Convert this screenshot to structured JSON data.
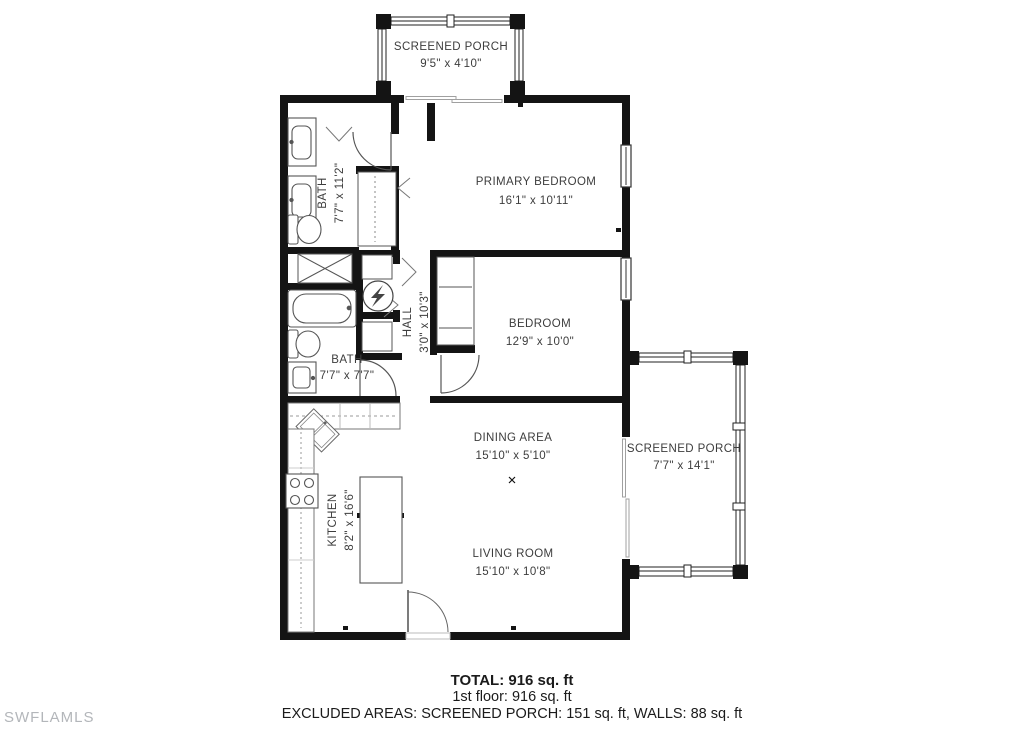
{
  "watermark": "SWFLAMLS",
  "rooms": {
    "screened_porch_top": {
      "name": "SCREENED PORCH",
      "dims": "9'5\" x 4'10\""
    },
    "primary_bedroom": {
      "name": "PRIMARY BEDROOM",
      "dims": "16'1\" x 10'11\""
    },
    "bath_upper": {
      "name": "BATH",
      "dims": "7'7\" x 11'2\""
    },
    "bedroom": {
      "name": "BEDROOM",
      "dims": "12'9\" x 10'0\""
    },
    "hall": {
      "name": "HALL",
      "dims": "3'0\" x 10'3\""
    },
    "bath_lower": {
      "name": "BATH",
      "dims": "7'7\" x 7'7\""
    },
    "kitchen": {
      "name": "KITCHEN",
      "dims": "8'2\" x 16'6\""
    },
    "dining_area": {
      "name": "DINING AREA",
      "dims": "15'10\" x 5'10\""
    },
    "living_room": {
      "name": "LIVING ROOM",
      "dims": "15'10\" x 10'8\""
    },
    "screened_porch_right": {
      "name": "SCREENED PORCH",
      "dims": "7'7\" x 14'1\""
    }
  },
  "summary": {
    "total": "TOTAL: 916 sq. ft",
    "first_floor": "1st floor: 916 sq. ft",
    "excluded": "EXCLUDED AREAS: SCREENED PORCH: 151 sq. ft, WALLS: 88 sq. ft"
  },
  "colors": {
    "wall": "#141414",
    "label_text": "#3d3d3d",
    "fixture_stroke": "#555555",
    "slider_gray": "#a0a0a0",
    "watermark": "#b3b6ba"
  }
}
